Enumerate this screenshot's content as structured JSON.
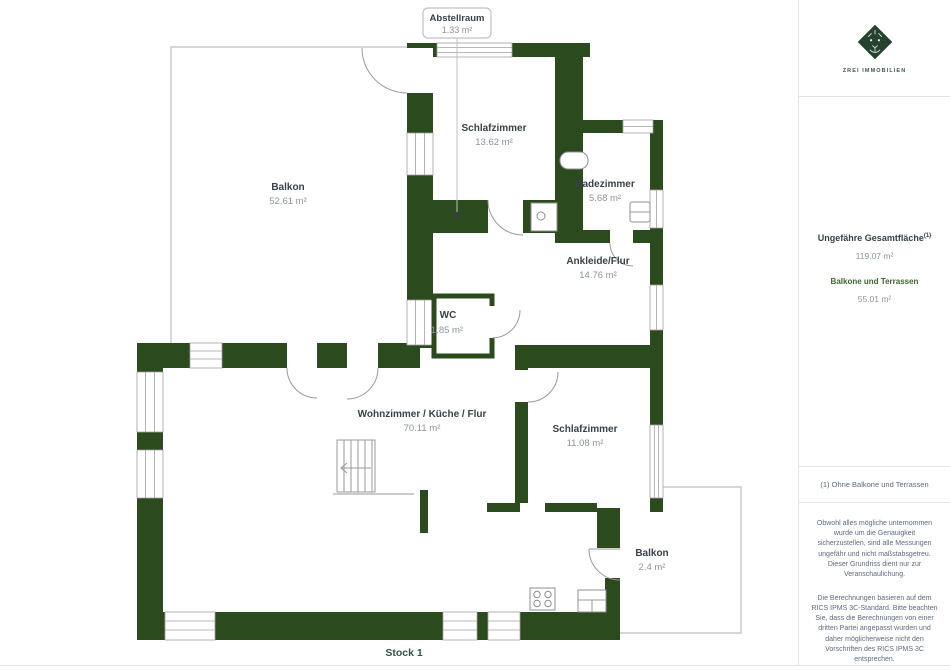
{
  "plan": {
    "floor_label": "Stock 1",
    "callout": {
      "name": "Abstellraum",
      "area": "1.33 m²"
    },
    "rooms": [
      {
        "id": "balkon-1",
        "name": "Balkon",
        "area": "52.61 m²"
      },
      {
        "id": "schlafzimmer-1",
        "name": "Schlafzimmer",
        "area": "13.62 m²"
      },
      {
        "id": "badezimmer",
        "name": "Badezimmer",
        "area": "5.68 m²"
      },
      {
        "id": "ankleide-flur",
        "name": "Ankleide/Flur",
        "area": "14.76 m²"
      },
      {
        "id": "wc",
        "name": "WC",
        "area": "1.85 m²"
      },
      {
        "id": "wohnzimmer",
        "name": "Wohnzimmer / Küche / Flur",
        "area": "70.11 m²"
      },
      {
        "id": "schlafzimmer-2",
        "name": "Schlafzimmer",
        "area": "11.08 m²"
      },
      {
        "id": "balkon-2",
        "name": "Balkon",
        "area": "2.4 m²"
      }
    ]
  },
  "sidebar": {
    "logo_text": "ZREI IMMOBILIEN",
    "total_area": {
      "label": "Ungefähre Gesamtfläche",
      "superscript": "(1)",
      "value": "119.07 m²"
    },
    "balcony_area": {
      "label": "Balkone und Terrassen",
      "value": "55.01 m²"
    },
    "footnote": "(1) Ohne Balkone und Terrassen",
    "disclaimer1": "Obwohl alles mögliche unternommen wurde um die Genauigkeit sicherzustellen, sind alle Messungen ungefähr und nicht maßstabsgetreu. Dieser Grundriss dient nur zur Veranschaulichung.",
    "disclaimer2": "Die Berechnungen basieren auf dem RICS IPMS 3C-Standard. Bitte beachten Sie, dass die Berechnungen von einer dritten Partei angepasst wurden und daher möglicherweise nicht den Vorschriften des RICS IPMS 3C entsprechen."
  },
  "colors": {
    "wall_green": "#2b4a1d",
    "accent_green": "#3f6532",
    "muted_text": "#8b959b",
    "dark_text": "#37424a"
  }
}
